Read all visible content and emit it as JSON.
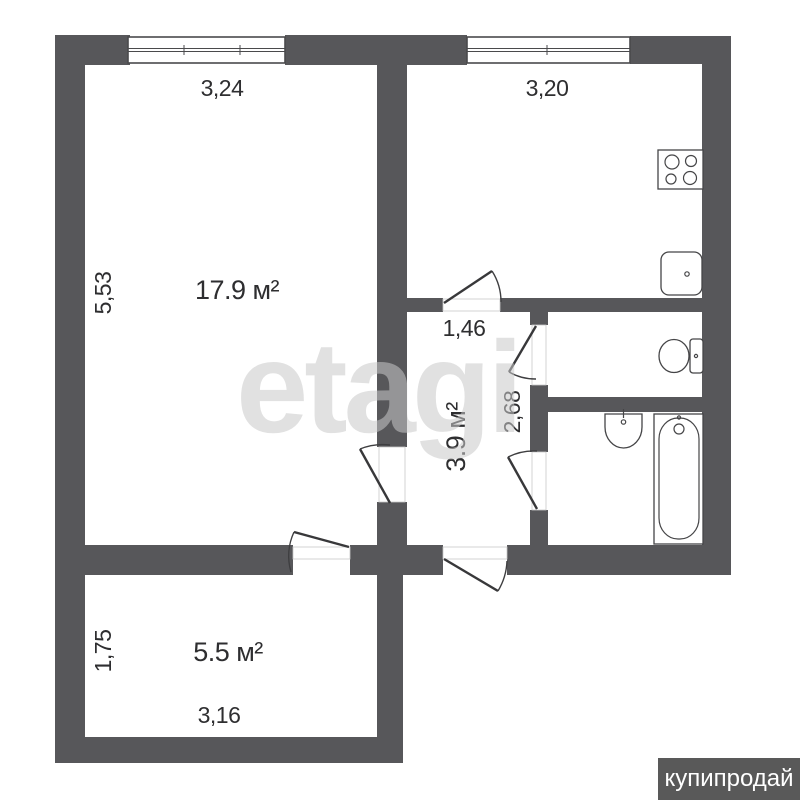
{
  "document_type": "apartment floor plan",
  "rooms": [
    {
      "name": "living-room",
      "area": "17.9 м²",
      "width": "3,24",
      "depth": "5,53"
    },
    {
      "name": "kitchen",
      "width": "3,20"
    },
    {
      "name": "hallway",
      "area": "3.9 м²",
      "width": "1,46",
      "depth": "2,68"
    },
    {
      "name": "small-room",
      "area": "5.5 м²",
      "width": "3,16",
      "depth": "1,75"
    }
  ],
  "fixtures": [
    "stove-icon",
    "kitchen-sink-icon",
    "toilet-icon",
    "washbasin-icon",
    "bathtub-icon"
  ],
  "watermark": {
    "text": "etagi"
  },
  "badge": {
    "text": "купипродай"
  },
  "colors": {
    "wall": "#57575a",
    "floor": "#ffffff",
    "badge_background": "#595959",
    "badge_text": "#ffffff",
    "watermark_gray": "#c9c9c9",
    "label_text": "#2e2e30"
  }
}
